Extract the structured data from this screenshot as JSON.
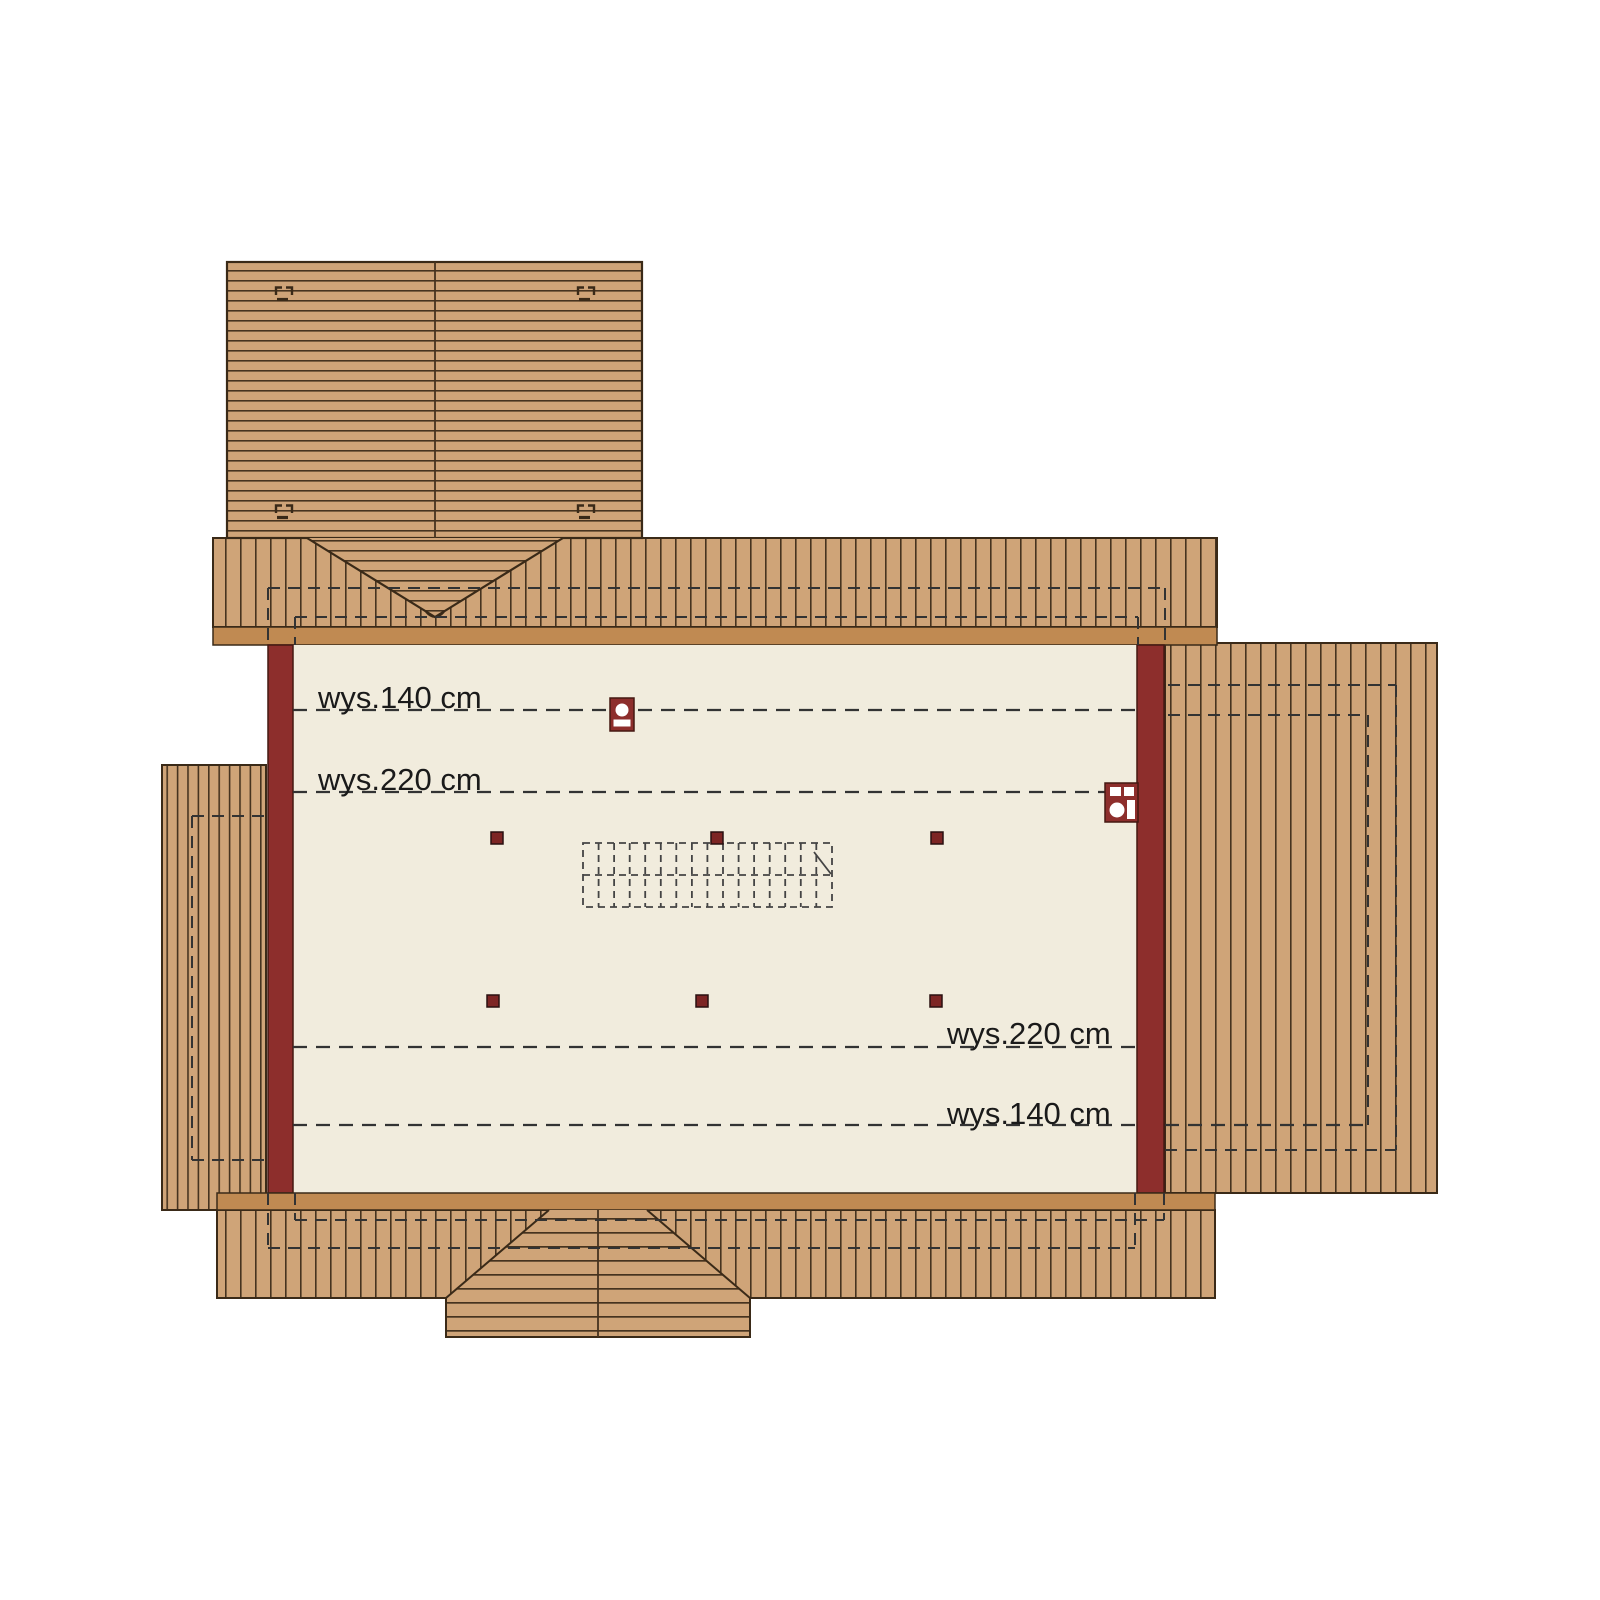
{
  "plan": {
    "type": "attic-floor-plan",
    "labels": {
      "top_140": "wys.140 cm",
      "top_220": "wys.220 cm",
      "bottom_220": "wys.220 cm",
      "bottom_140": "wys.140 cm"
    },
    "height_lines": [
      {
        "label": "wys.140 cm",
        "position": "top"
      },
      {
        "label": "wys.220 cm",
        "position": "top"
      },
      {
        "label": "wys.220 cm",
        "position": "bottom"
      },
      {
        "label": "wys.140 cm",
        "position": "bottom"
      }
    ],
    "colors": {
      "roof_plank": "#cfa478",
      "plank_line": "#46331f",
      "eave_band": "#c08a52",
      "outline": "#3a2a18",
      "floor": "#f1ecdd",
      "wall": "#8d2e2c",
      "dash_line": "#333333",
      "post": "#7d2524",
      "background": "#ffffff",
      "text": "#1a1a1a"
    }
  }
}
